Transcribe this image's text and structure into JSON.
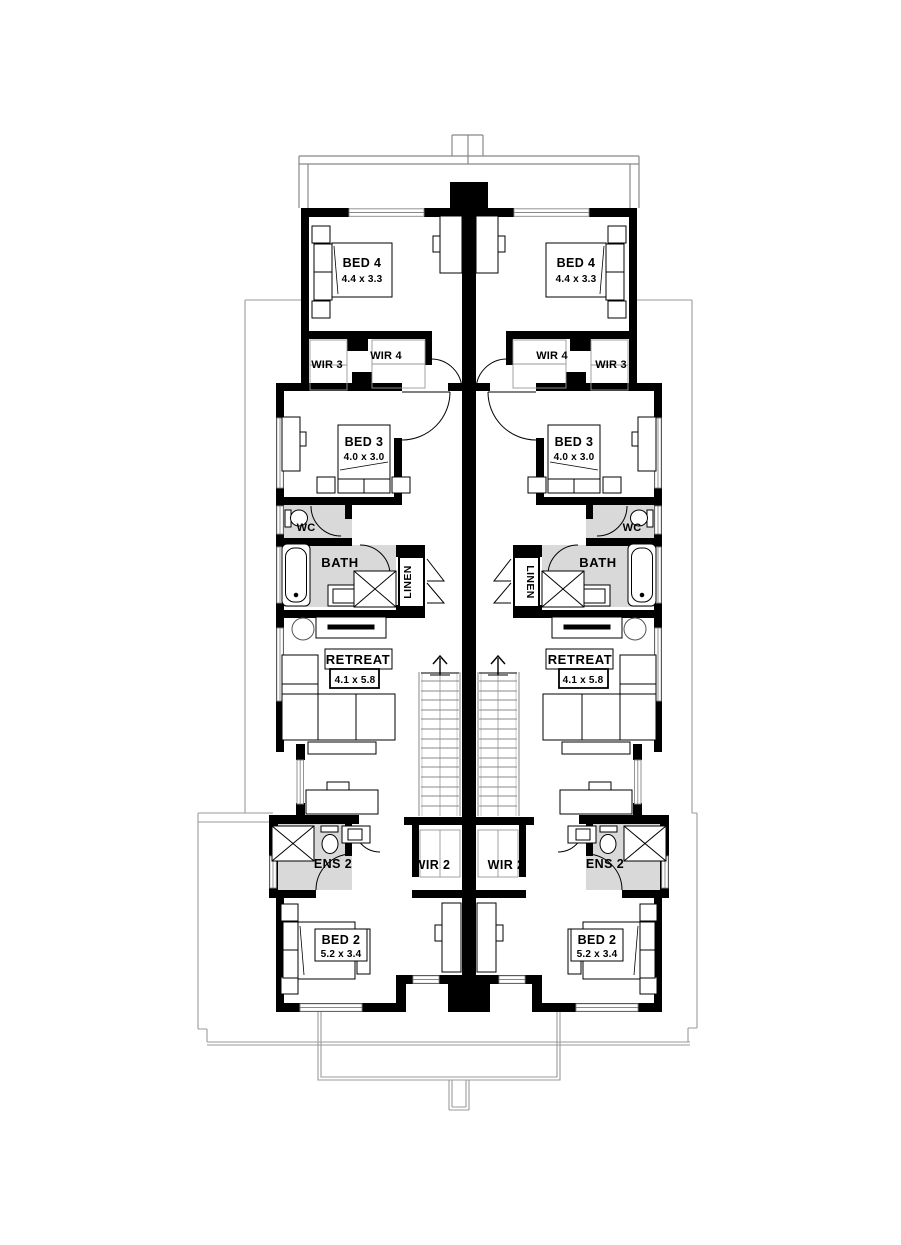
{
  "floor_plan": {
    "type": "duplex-upper-floor-plan",
    "wall_color": "#000000",
    "wet_area_color": "#d9d9d9",
    "outline_color": "#999999",
    "units": {
      "left": {
        "bed4": {
          "label": "BED 4",
          "dim": "4.4 x 3.3"
        },
        "wir3": {
          "label": "WIR 3"
        },
        "wir4": {
          "label": "WIR 4"
        },
        "bed3": {
          "label": "BED 3",
          "dim": "4.0 x 3.0"
        },
        "wc": {
          "label": "WC"
        },
        "bath": {
          "label": "BATH"
        },
        "linen": {
          "label": "LINEN"
        },
        "retreat": {
          "label": "RETREAT",
          "dim": "4.1 x 5.8"
        },
        "ens2": {
          "label": "ENS 2"
        },
        "wir2": {
          "label": "WIR 2"
        },
        "bed2": {
          "label": "BED 2",
          "dim": "5.2 x 3.4"
        }
      },
      "right": {
        "bed4": {
          "label": "BED 4",
          "dim": "4.4 x 3.3"
        },
        "wir3": {
          "label": "WIR 3"
        },
        "wir4": {
          "label": "WIR 4"
        },
        "bed3": {
          "label": "BED 3",
          "dim": "4.0 x 3.0"
        },
        "wc": {
          "label": "WC"
        },
        "bath": {
          "label": "BATH"
        },
        "linen": {
          "label": "LINEN"
        },
        "retreat": {
          "label": "RETREAT",
          "dim": "4.1 x 5.8"
        },
        "ens2": {
          "label": "ENS 2"
        },
        "wir2": {
          "label": "WIR 2"
        },
        "bed2": {
          "label": "BED 2",
          "dim": "5.2 x 3.4"
        }
      }
    }
  }
}
